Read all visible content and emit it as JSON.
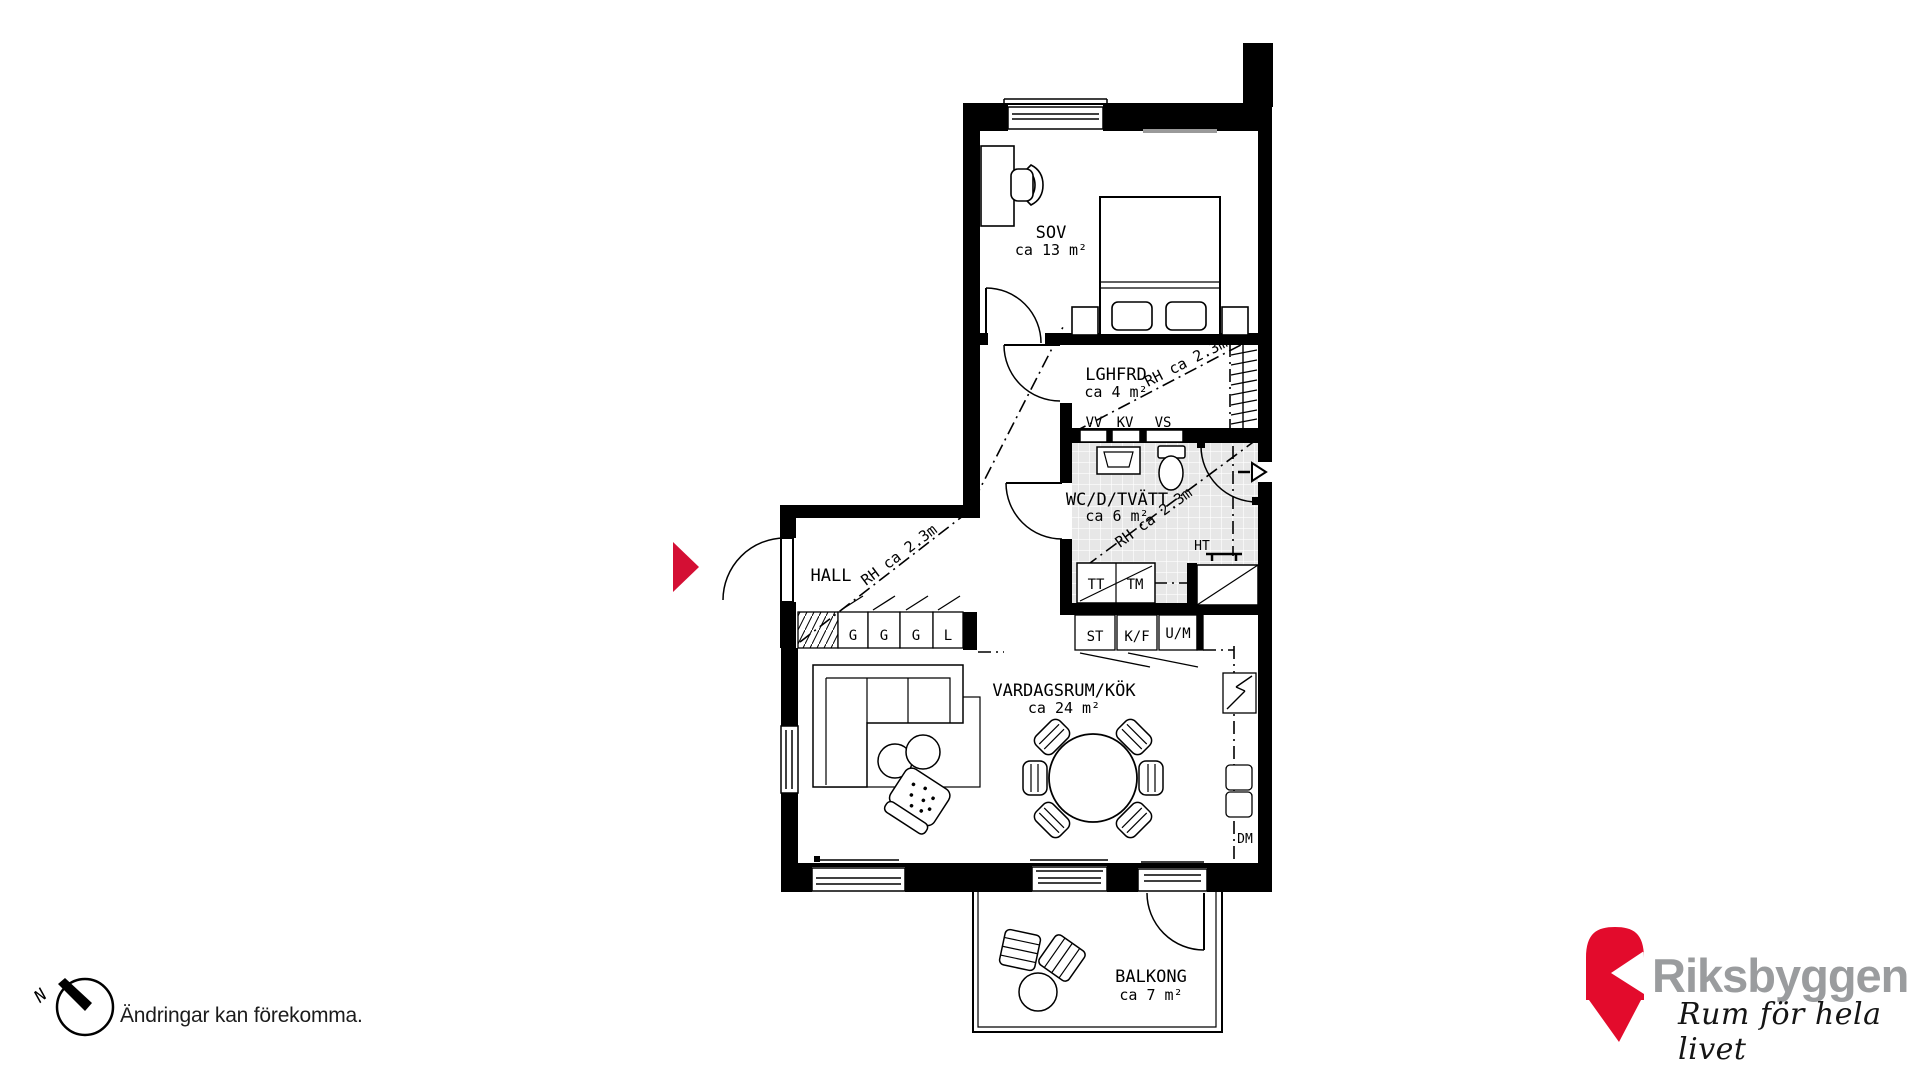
{
  "rooms": {
    "bedroom": {
      "name": "SOV",
      "area": "ca 13 m²"
    },
    "storage": {
      "name": "LGHFRD",
      "area": "ca 4 m²"
    },
    "bathroom": {
      "name": "WC/D/TVÄTT",
      "area": "ca 6 m²"
    },
    "hall": {
      "name": "HALL"
    },
    "living": {
      "name": "VARDAGSRUM/KÖK",
      "area": "ca 24 m²"
    },
    "balcony": {
      "name": "BALKONG",
      "area": "ca 7 m²"
    }
  },
  "units": {
    "closets": [
      "G",
      "G",
      "G",
      "L"
    ],
    "kitchen": [
      "ST",
      "K/F",
      "U/M"
    ],
    "laundry": [
      "TT",
      "TM"
    ],
    "utility": [
      "VV",
      "KV",
      "VS"
    ],
    "towel_rail": "HT",
    "dishwasher": "DM"
  },
  "notes": {
    "ceiling_height": "RH ca 2.3m",
    "disclaimer": "Ändringar kan förekomma.",
    "north": "N"
  },
  "brand": {
    "name": "Riksbyggen",
    "tagline": "Rum för hela livet",
    "red": "#E30B2C",
    "gray": "#9A9C9E"
  },
  "entrance_marker_color": "#D40F34"
}
